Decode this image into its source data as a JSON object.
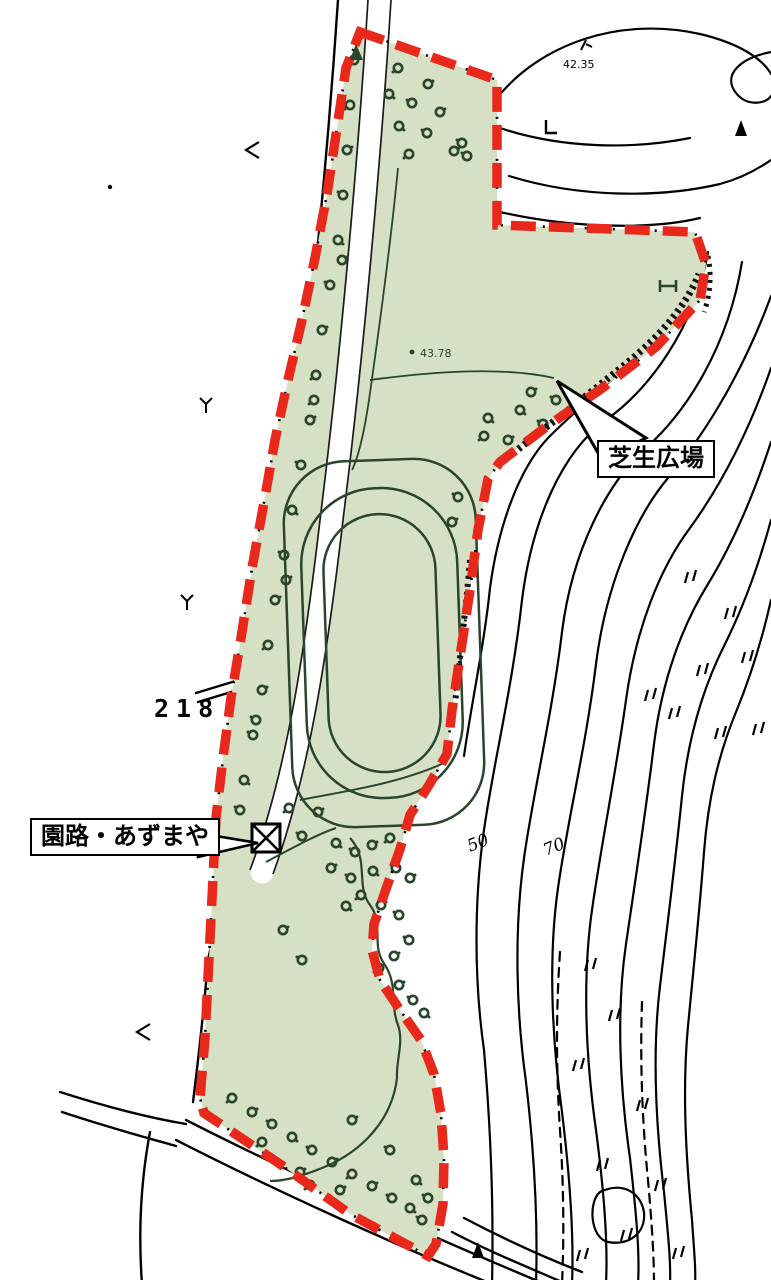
{
  "labels": {
    "lawn_plaza": "芝生広場",
    "path_gazebo": "園路・あずまや"
  },
  "annotations": {
    "road_number": "218",
    "spot_elevation_top": "42.35",
    "spot_elevation_mid": "43.78",
    "contour_label_left": "50",
    "contour_label_right": "70"
  },
  "colors": {
    "background": "#ffffff",
    "park_fill": "#d6e0c5",
    "boundary_red": "#e8281b",
    "vegetation_green": "#29452c",
    "linework_black": "#000000"
  },
  "symbols": {
    "gazebo": "square-with-x",
    "benchmark": "filled-triangle",
    "tree": "dark-green-scribble-circle",
    "field_mark": "double-tick"
  }
}
